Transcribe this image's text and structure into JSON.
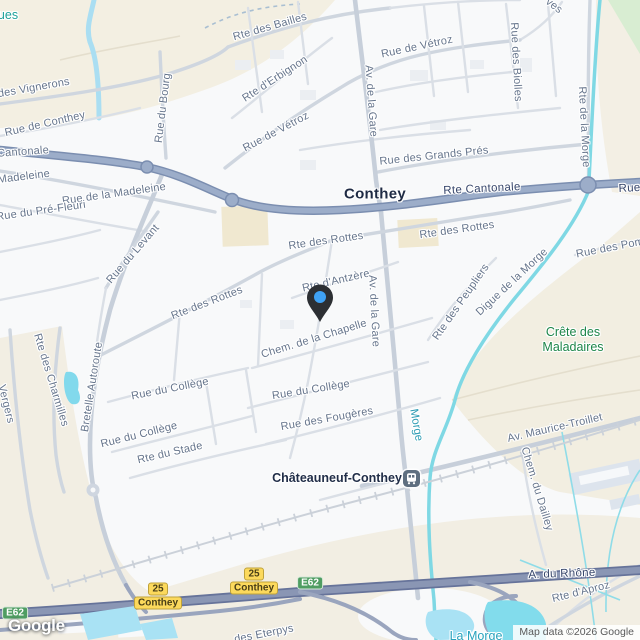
{
  "map": {
    "logo": "Google",
    "attribution": "Map data ©2026 Google",
    "colors": {
      "pin_body": "#2c2f33",
      "pin_dot": "#3fa2f5",
      "exit_badge_yellow": "#fcd95c",
      "e_route_green": "#4f9d62",
      "water_teal": "#7fd8e4",
      "park_label_green": "#1d8649",
      "main_road_blue": "#9cadc9",
      "motorway_blue": "#8a96b4"
    },
    "city_labels": [
      {
        "text": "Conthey",
        "x": 375,
        "y": 194,
        "rot": 0,
        "cls": "city",
        "name": "city-label-conthey"
      },
      {
        "text": "Châteauneuf-Conthey",
        "x": 337,
        "y": 478,
        "rot": 0,
        "cls": "city-sm",
        "name": "city-label-chateauneuf-conthey"
      }
    ],
    "street_labels": [
      {
        "text": "Rte des Bailles",
        "x": 270,
        "y": 27,
        "rot": -16,
        "cls": "street"
      },
      {
        "text": "Rte d'Erbignon",
        "x": 275,
        "y": 79,
        "rot": -33,
        "cls": "street"
      },
      {
        "text": "Rue de Vétroz",
        "x": 276,
        "y": 132,
        "rot": -28,
        "cls": "street"
      },
      {
        "text": "Rue de Vétroz",
        "x": 417,
        "y": 47,
        "rot": -12,
        "cls": "street"
      },
      {
        "text": "Rue du Bourg",
        "x": 163,
        "y": 108,
        "rot": -83,
        "cls": "street"
      },
      {
        "text": "Rue des Biolles",
        "x": 516,
        "y": 62,
        "rot": 87,
        "cls": "street"
      },
      {
        "text": "Rte de la Morge",
        "x": 584,
        "y": 127,
        "rot": 87,
        "cls": "street"
      },
      {
        "text": "Rue des Vignerons",
        "x": 22,
        "y": 90,
        "rot": -10,
        "cls": "street"
      },
      {
        "text": "Rue de Conthey",
        "x": 45,
        "y": 124,
        "rot": -13,
        "cls": "street"
      },
      {
        "text": "Cantonale",
        "x": 23,
        "y": 152,
        "rot": -4,
        "cls": "street"
      },
      {
        "text": "Rue de la Madeleine",
        "x": -2,
        "y": 180,
        "rot": -7,
        "cls": "street"
      },
      {
        "text": "Rue de la Madeleine",
        "x": 114,
        "y": 194,
        "rot": -8,
        "cls": "street"
      },
      {
        "text": "Rue du Pré-Fleuri",
        "x": 41,
        "y": 211,
        "rot": -8,
        "cls": "street"
      },
      {
        "text": "Rue des Grands Prés",
        "x": 434,
        "y": 156,
        "rot": -6,
        "cls": "street"
      },
      {
        "text": "Rte Cantonale",
        "x": 482,
        "y": 189,
        "rot": -3,
        "cls": "road-on"
      },
      {
        "text": "Rue de",
        "x": 638,
        "y": 188,
        "rot": -3,
        "cls": "road-on"
      },
      {
        "text": "Rte des Rottes",
        "x": 326,
        "y": 241,
        "rot": -8,
        "cls": "street"
      },
      {
        "text": "Rte des Rottes",
        "x": 457,
        "y": 230,
        "rot": -8,
        "cls": "street"
      },
      {
        "text": "Rue des Pom",
        "x": 610,
        "y": 248,
        "rot": -11,
        "cls": "street"
      },
      {
        "text": "Rue du Levant",
        "x": 133,
        "y": 254,
        "rot": -49,
        "cls": "street"
      },
      {
        "text": "Rte des Rottes",
        "x": 207,
        "y": 303,
        "rot": -21,
        "cls": "street"
      },
      {
        "text": "Rte d'Antzère",
        "x": 336,
        "y": 281,
        "rot": -13,
        "cls": "street"
      },
      {
        "text": "Av. de la Gare",
        "x": 371,
        "y": 101,
        "rot": 86,
        "cls": "street"
      },
      {
        "text": "Av. de la Gare",
        "x": 374,
        "y": 311,
        "rot": 87,
        "cls": "street"
      },
      {
        "text": "Rte des Peupliers",
        "x": 461,
        "y": 302,
        "rot": -55,
        "cls": "street"
      },
      {
        "text": "Digue de la Morge",
        "x": 512,
        "y": 282,
        "rot": -43,
        "cls": "street"
      },
      {
        "text": "Chem. de la Chapelle",
        "x": 314,
        "y": 339,
        "rot": -17,
        "cls": "street"
      },
      {
        "text": "Bretelle Autoroute",
        "x": 92,
        "y": 387,
        "rot": -81,
        "cls": "street"
      },
      {
        "text": "Rte des Charmilles",
        "x": 51,
        "y": 380,
        "rot": 73,
        "cls": "street"
      },
      {
        "text": "Vergers",
        "x": 6,
        "y": 404,
        "rot": 76,
        "cls": "street"
      },
      {
        "text": "Rue du Collège",
        "x": 170,
        "y": 389,
        "rot": -11,
        "cls": "street"
      },
      {
        "text": "Rue du Collège",
        "x": 139,
        "y": 435,
        "rot": -14,
        "cls": "street"
      },
      {
        "text": "Rte du Stade",
        "x": 170,
        "y": 453,
        "rot": -13,
        "cls": "street"
      },
      {
        "text": "Rue du Collège",
        "x": 311,
        "y": 390,
        "rot": -9,
        "cls": "street"
      },
      {
        "text": "Rue des Fougères",
        "x": 327,
        "y": 419,
        "rot": -10,
        "cls": "street"
      },
      {
        "text": "Av. Maurice-Troillet",
        "x": 555,
        "y": 428,
        "rot": -13,
        "cls": "street"
      },
      {
        "text": "Chem. du Dailley",
        "x": 537,
        "y": 489,
        "rot": 73,
        "cls": "street"
      },
      {
        "text": "A. du Rhône",
        "x": 562,
        "y": 574,
        "rot": -2,
        "cls": "road-on"
      },
      {
        "text": "Rte d'Aproz",
        "x": 581,
        "y": 592,
        "rot": -14,
        "cls": "street"
      },
      {
        "text": "des Eterpys",
        "x": 264,
        "y": 634,
        "rot": -11,
        "cls": "street"
      },
      {
        "text": "ves",
        "x": 554,
        "y": 6,
        "rot": 38,
        "cls": "street"
      }
    ],
    "area_labels": [
      {
        "text": "Crête des Maladaires",
        "x": 573,
        "y": 340,
        "rot": 0,
        "cls": "area",
        "name": "area-label-crete-des-maladaires"
      }
    ],
    "water_labels": [
      {
        "text": "Morge",
        "x": 416,
        "y": 425,
        "rot": 80,
        "cls": "water",
        "name": "water-label-morge"
      },
      {
        "text": "La Morge",
        "x": 476,
        "y": 636,
        "rot": 0,
        "cls": "water-lg",
        "name": "water-label-la-morge"
      },
      {
        "text": "ues",
        "x": 8,
        "y": 15,
        "rot": 0,
        "cls": "water-grn",
        "name": "water-label-partial"
      }
    ],
    "badges": [
      {
        "type": "exit",
        "number": "25",
        "name_line": "Conthey",
        "x": 158,
        "y": 596
      },
      {
        "type": "exit",
        "number": "25",
        "name_line": "Conthey",
        "x": 254,
        "y": 581
      },
      {
        "type": "route",
        "text": "E62",
        "x": 15,
        "y": 613
      },
      {
        "type": "route",
        "text": "E62",
        "x": 310,
        "y": 583
      }
    ],
    "poi": {
      "station_name": "Châteauneuf-Conthey"
    }
  }
}
